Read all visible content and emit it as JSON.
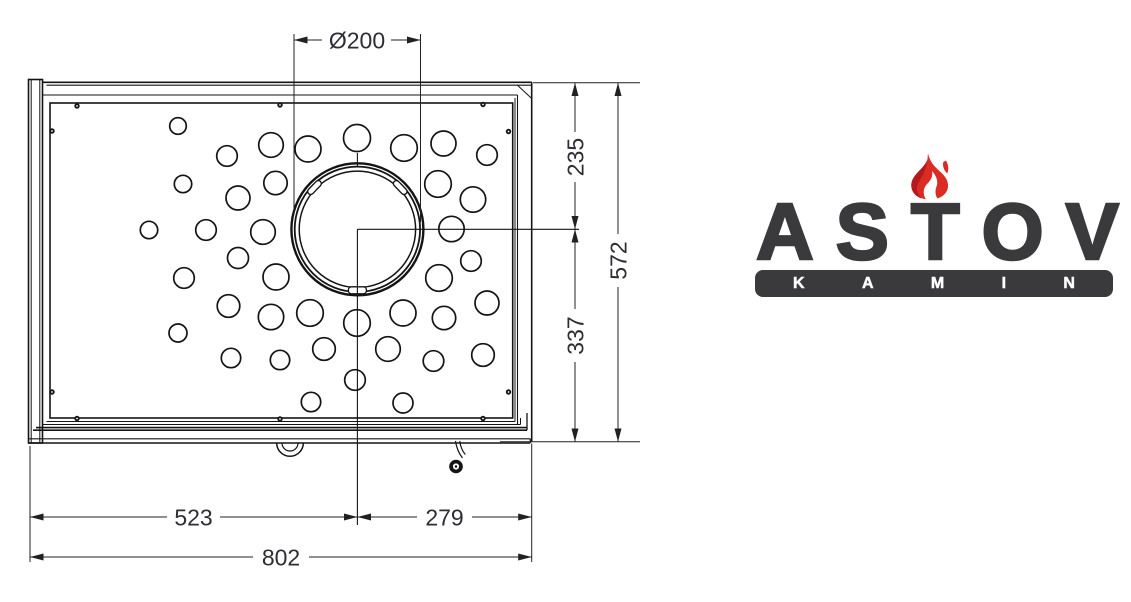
{
  "drawing": {
    "dims": {
      "flue": "Ø200",
      "top_right": "235",
      "bottom_right_v": "337",
      "overall_height": "572",
      "left_to_center": "523",
      "center_to_right": "279",
      "overall_width": "802"
    },
    "line_color": "#141414",
    "dim_text_color": "#2c2e33",
    "holes": [
      [
        178,
        126,
        8.3
      ],
      [
        227,
        156,
        10.3
      ],
      [
        271,
        145,
        12.3
      ],
      [
        183,
        184,
        8.7
      ],
      [
        238,
        198,
        12
      ],
      [
        275.5,
        183,
        11.7
      ],
      [
        149,
        230,
        8.7
      ],
      [
        206,
        230,
        10.3
      ],
      [
        263,
        232,
        12.3
      ],
      [
        238,
        258,
        10.5
      ],
      [
        308,
        149,
        13
      ],
      [
        357,
        138,
        13.5
      ],
      [
        404,
        148,
        13.3
      ],
      [
        443.5,
        143.5,
        12.5
      ],
      [
        487,
        155,
        10.3
      ],
      [
        438,
        184,
        13.3
      ],
      [
        473,
        199.5,
        12.7
      ],
      [
        451.5,
        229,
        12.7
      ],
      [
        184,
        278,
        10.3
      ],
      [
        276,
        277,
        13
      ],
      [
        228.5,
        306,
        11.3
      ],
      [
        271,
        317,
        12.7
      ],
      [
        178,
        333,
        9
      ],
      [
        231,
        358,
        9.7
      ],
      [
        280,
        360,
        9.7
      ],
      [
        310,
        313,
        13.3
      ],
      [
        357,
        323,
        13.3
      ],
      [
        403,
        313,
        13
      ],
      [
        439,
        278,
        13.3
      ],
      [
        471,
        261,
        10.3
      ],
      [
        324,
        349,
        11.3
      ],
      [
        388,
        349,
        12.3
      ],
      [
        444,
        318,
        11.7
      ],
      [
        433.5,
        361,
        10.3
      ],
      [
        487,
        303,
        12
      ],
      [
        483,
        355,
        11.3
      ],
      [
        355,
        380,
        10.3
      ],
      [
        311,
        402,
        9.7
      ],
      [
        403,
        403,
        10
      ]
    ],
    "screws": [
      [
        77,
        106
      ],
      [
        280,
        105
      ],
      [
        483,
        104.5
      ],
      [
        52,
        131
      ],
      [
        508.5,
        131.5
      ],
      [
        52,
        392
      ],
      [
        508.5,
        392
      ],
      [
        77,
        418.5
      ],
      [
        280,
        419
      ],
      [
        483,
        418.5
      ]
    ]
  },
  "logo": {
    "brand": "ASTOV",
    "subtitle": "KAMIN",
    "text_color": "#3a393b",
    "bar_color": "#3a393b",
    "flame_red": "#da2c24",
    "flame_dark_red": "#b5191c"
  }
}
